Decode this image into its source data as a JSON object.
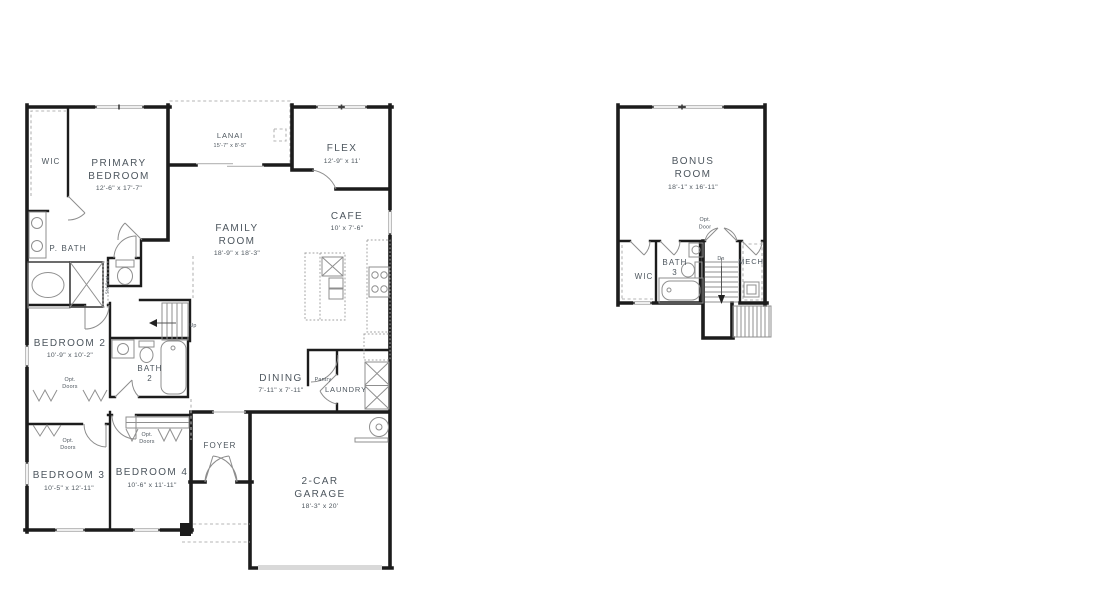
{
  "palette": {
    "wall": "#1c1c1c",
    "thin": "#8f8f8f",
    "dash": "#b4b4b4",
    "text": "#4d565e",
    "garage_door": "#d9d9d9"
  },
  "f1": {
    "wic": "WIC",
    "primary": {
      "l1": "PRIMARY",
      "l2": "BEDROOM",
      "dims": "12'-6\" x 17'-7\""
    },
    "lanai": {
      "name": "LANAI",
      "dims": "15'-7\" x 8'-5\""
    },
    "flex": {
      "name": "FLEX",
      "dims": "12'-9\" x 11'"
    },
    "cafe": {
      "name": "CAFE",
      "dims": "10' x 7'-6\""
    },
    "family": {
      "l1": "FAMILY",
      "l2": "ROOM",
      "dims": "18'-9\" x 18'-3\""
    },
    "pbath": "P. BATH",
    "std_seat": "Std Seat",
    "bed2": {
      "name": "BEDROOM 2",
      "dims": "10'-9\" x 10'-2\""
    },
    "bath2": {
      "l1": "BATH",
      "l2": "2"
    },
    "up": "Up",
    "dining": {
      "name": "DINING",
      "dims": "7'-11\" x 7'-11\""
    },
    "pantry": "Pantry",
    "laundry": "LAUNDRY",
    "opt_doors": {
      "l1": "Opt.",
      "l2": "Doors"
    },
    "bed3": {
      "name": "BEDROOM 3",
      "dims": "10'-5\" x 12'-11\""
    },
    "bed4": {
      "name": "BEDROOM 4",
      "dims": "10'-6\" x 11'-11\""
    },
    "foyer": "FOYER",
    "garage": {
      "l1": "2-CAR",
      "l2": "GARAGE",
      "dims": "18'-3\" x 20'"
    }
  },
  "f2": {
    "bonus": {
      "l1": "BONUS",
      "l2": "ROOM",
      "dims": "18'-1\" x 16'-11\""
    },
    "wic": "WIC",
    "bath3": {
      "l1": "BATH",
      "l2": "3"
    },
    "mech": "MECH",
    "dn": "Dn",
    "opt_door": {
      "l1": "Opt.",
      "l2": "Door"
    }
  }
}
